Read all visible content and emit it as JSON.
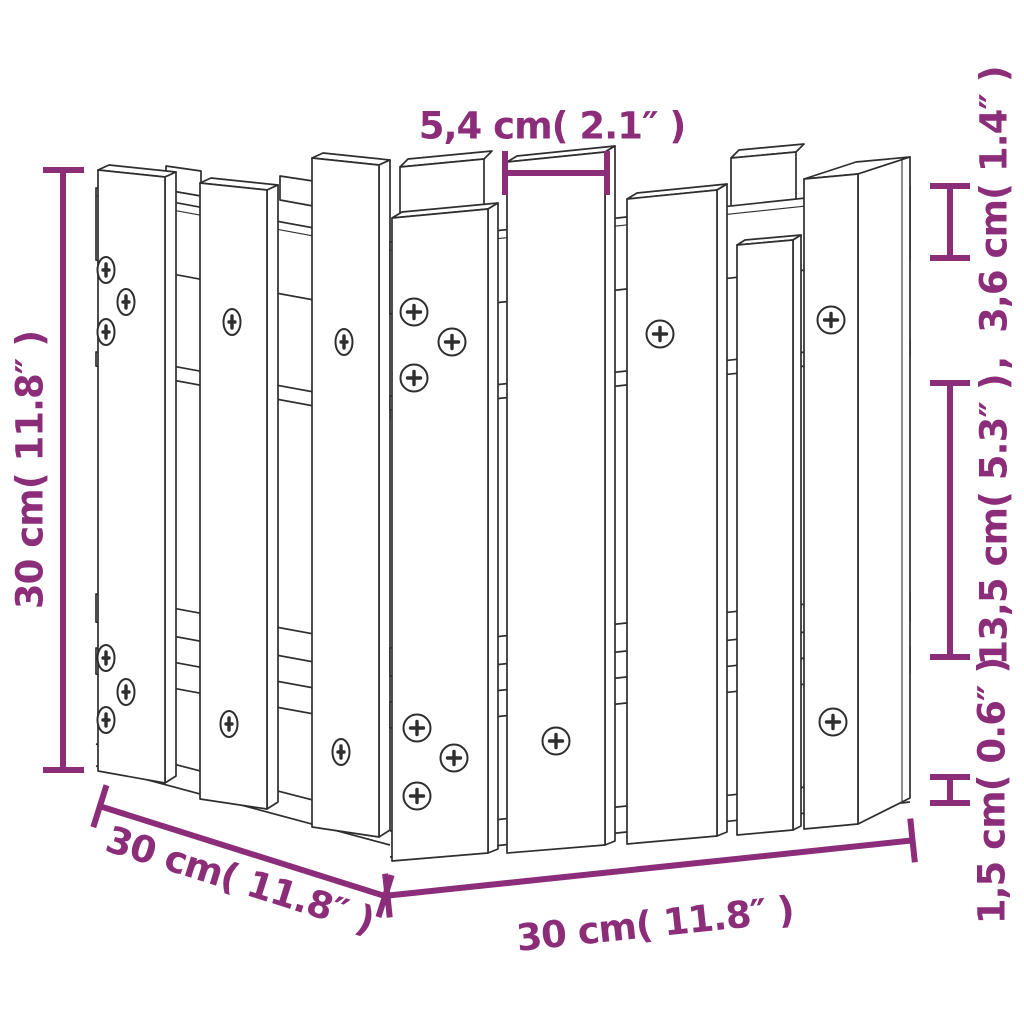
{
  "drawing": {
    "subject": "wooden garden planter with picket-fence (castle style) sides",
    "style": "black outline technical product illustration on white",
    "elements": [
      "picket-board",
      "horizontal-rail",
      "bottom-plank",
      "phillips-screw"
    ]
  },
  "colors": {
    "dimension_annotation": "#8c2d7a",
    "line_art": "#2e2e2e",
    "background": "#ffffff"
  },
  "dims": {
    "top_width": {
      "label": "5,4 cm( 2.1″ )",
      "cm": "5,4",
      "inch": "2.1"
    },
    "left_height": {
      "label": "30 cm( 11.8″ )",
      "cm": "30",
      "inch": "11.8"
    },
    "right_rail": {
      "label": ",  3,6 cm( 1.4″ )",
      "cm": "3,6",
      "inch": "1.4"
    },
    "right_board": {
      "label": "13,5 cm( 5.3″ )",
      "cm": "13,5",
      "inch": "5.3"
    },
    "right_plank": {
      "label": "1,5 cm( 0.6″ )",
      "cm": "1,5",
      "inch": "0.6"
    },
    "depth": {
      "label": "30 cm( 11.8″ )",
      "cm": "30",
      "inch": "11.8"
    },
    "bottom_width": {
      "label": "30 cm( 11.8″ )",
      "cm": "30",
      "inch": "11.8"
    }
  }
}
